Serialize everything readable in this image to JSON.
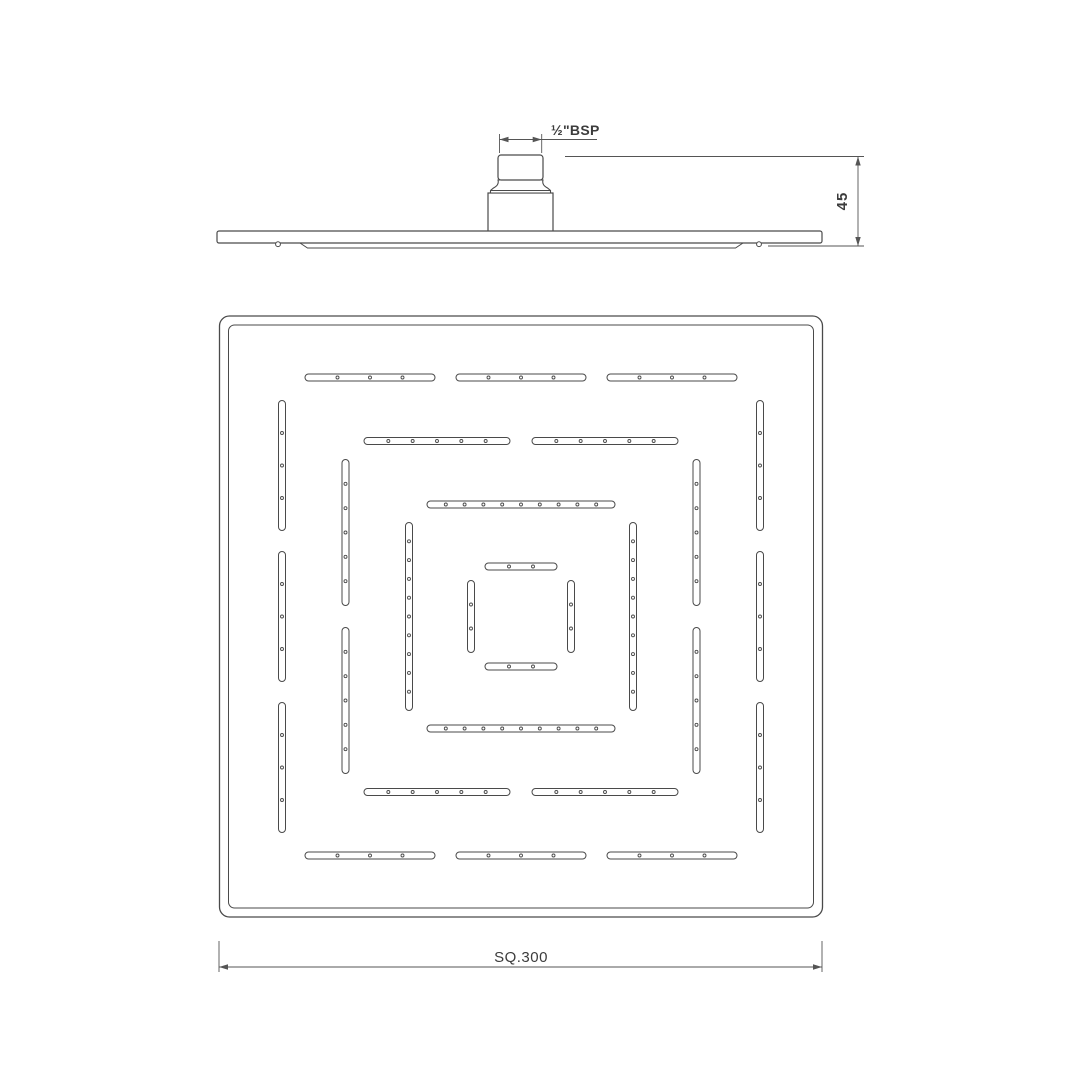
{
  "title": "Square overhead rain shower - technical drawing",
  "colors": {
    "line": "#4a4a4a",
    "dim": "#555555",
    "text": "#3c3c3c",
    "bg": "#ffffff"
  },
  "side_view": {
    "bsp_label": "½\"BSP",
    "height_label": "45",
    "plate": {
      "x": 217,
      "y": 231,
      "w": 605,
      "h": 12
    },
    "lip": {
      "x1": 300,
      "x2": 743,
      "drop": 5,
      "chamfer": 7.5
    },
    "nozzles_x": [
      278,
      759
    ],
    "base": {
      "x": 488,
      "y": 193,
      "w": 65,
      "h": 39.5
    },
    "nipple": {
      "x": 498,
      "y": 155,
      "w": 45,
      "h": 25
    },
    "bsp_dim": {
      "x1": 499.5,
      "x2": 541.7,
      "line_y": 139.5,
      "wit_y1": 134,
      "wit_y2": 153,
      "tail_x": 597
    },
    "h_dim": {
      "x": 858,
      "y1": 156.5,
      "y2": 246,
      "ext_top_x1": 565,
      "ext_bot_x1": 768,
      "ext_x2": 864
    }
  },
  "plan_view": {
    "size_label": "SQ.300",
    "outer": {
      "x": 219.5,
      "y": 316,
      "w": 603,
      "h": 601,
      "r": 10
    },
    "inner_inset": 9,
    "inner_r": 6,
    "center": {
      "x": 521,
      "y": 616.5
    },
    "slot_thickness": 7,
    "rings": [
      {
        "offset": 239,
        "slots_per_side": 3,
        "slot_length": 130,
        "gap": 21,
        "dots_per_slot": 3
      },
      {
        "offset": 175.5,
        "slots_per_side": 2,
        "slot_length": 146,
        "gap": 22,
        "dots_per_slot": 5
      },
      {
        "offset": 112,
        "slots_per_side": 1,
        "slot_length": 188,
        "gap": 0,
        "dots_per_slot": 9
      },
      {
        "offset": 50,
        "slots_per_side": 1,
        "slot_length": 72,
        "gap": 0,
        "dots_per_slot": 2
      }
    ],
    "sq_dim": {
      "x1": 219,
      "x2": 822,
      "line_y": 967,
      "tick_y1": 941,
      "tick_y2": 972
    }
  }
}
